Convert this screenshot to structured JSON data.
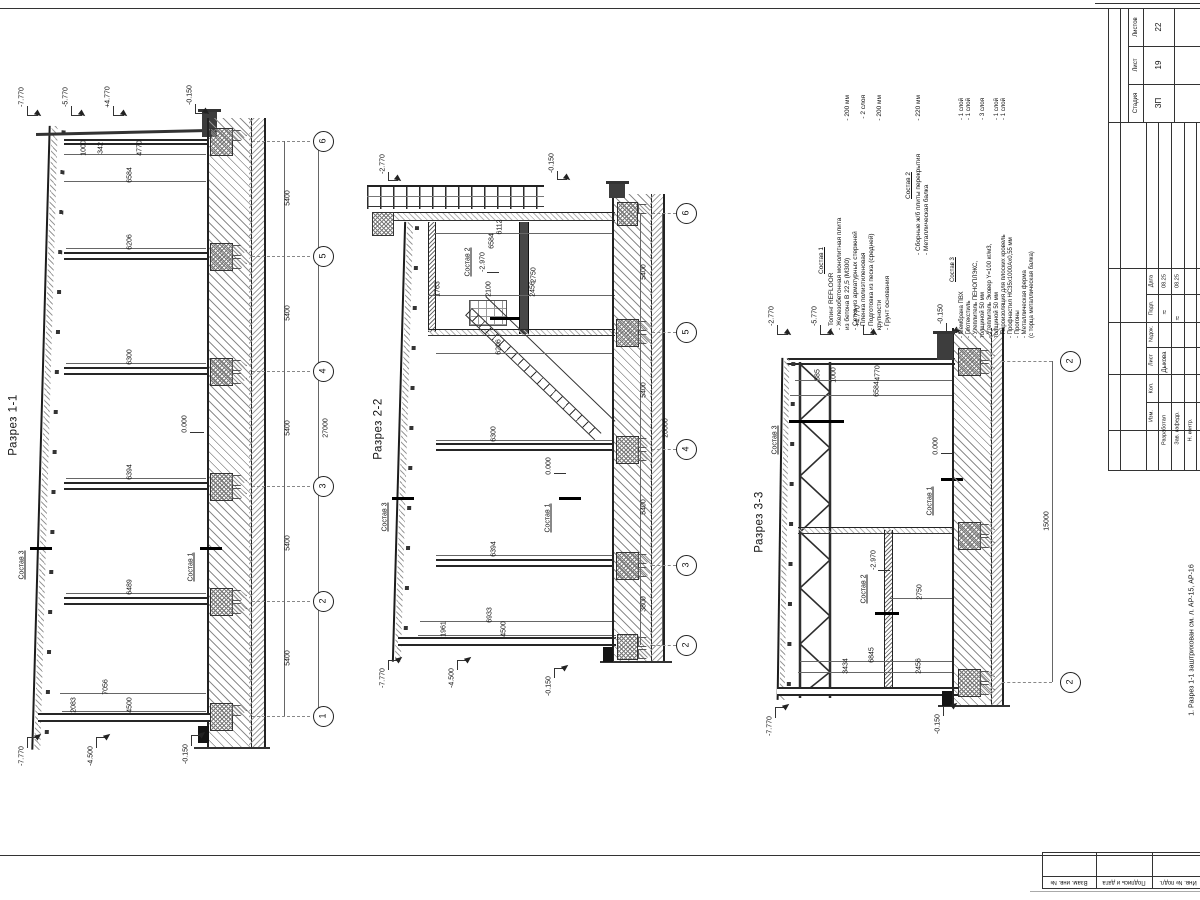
{
  "sheet": {
    "note_bottom": "1. Разрез 1-1 заштрихован см. л. АР-15, АР-16"
  },
  "sections": [
    {
      "title": "Разрез 1-1",
      "axes": [
        "6",
        "5",
        "4",
        "3",
        "2",
        "1"
      ],
      "bays": [
        "5400",
        "5400",
        "5400",
        "5400",
        "5400"
      ],
      "total": "27000",
      "dims": {
        "d1000": "1000",
        "d342": "342",
        "d4770": "4770",
        "d6584": "6584",
        "d6206": "6206",
        "d6300": "6300",
        "d6394": "6394",
        "d6489": "6489",
        "d7056": "7056",
        "d2083": "2083",
        "d4500": "4500"
      },
      "elev": {
        "t1": "-7.770",
        "t2": "-5.770",
        "t3": "+4.770",
        "t4": "-0.150",
        "m1": "0.000",
        "b1": "-7.770",
        "b2": "-4.500",
        "b3": "-0.150"
      },
      "marks": {
        "m1": "Состав 3",
        "m2": "Состав 1"
      }
    },
    {
      "title": "Разрез 2-2",
      "axes": [
        "6",
        "5",
        "4",
        "3",
        "2"
      ],
      "bays": [
        "5400",
        "5400",
        "5400",
        "3800"
      ],
      "total": "20000",
      "dims": {
        "d6112": "6112",
        "d6584": "6584",
        "d2750": "2750",
        "d2456": "2456",
        "d2100": "2100",
        "d1763": "1763",
        "d6206": "6206",
        "d6300": "6300",
        "d6394": "6394",
        "d6933": "6933",
        "d1961": "1961",
        "d4500": "4500"
      },
      "elev": {
        "t1": "-2.770",
        "t4": "-0.150",
        "m1": "0.000",
        "m2": "-2.970",
        "b1": "-7.770",
        "b2": "-4.500",
        "b3": "-0.150"
      },
      "marks": {
        "m1": "Состав 3",
        "m2": "Состав 1",
        "m3": "Состав 2"
      }
    },
    {
      "title": "Разрез 3-3",
      "axes": [
        "2",
        "2"
      ],
      "total": "15000",
      "dims": {
        "d385": "385",
        "d1000": "1000",
        "d4770": "4770",
        "d6584": "6584",
        "d2750": "2750",
        "d6845": "6845",
        "d3434": "3434",
        "d2456": "2456"
      },
      "elev": {
        "t1": "-2.770",
        "t2": "-5.770",
        "t3": "+4.770",
        "t4": "-0.150",
        "m1": "0.000",
        "m2": "-2.970",
        "b1": "-7.770",
        "b3": "-0.150"
      },
      "marks": {
        "m1": "Состав 3",
        "m2": "Состав 1",
        "m3": "Состав 2"
      }
    }
  ],
  "notes": {
    "s1": {
      "header": "Состав 1",
      "items": [
        {
          "t": "- Топинг REFLOOR",
          "v": ""
        },
        {
          "t": "- Железобетонная монолитная плита",
          "v": ""
        },
        {
          "t": "  из бетона В 22,5 (М300)",
          "v": "- 200 мм"
        },
        {
          "t": "- Сетка из арматурных стержней",
          "v": ""
        },
        {
          "t": "- Пленка полиэтиленовая",
          "v": "- 2 слоя"
        },
        {
          "t": "- Подготовка из песка (средней)",
          "v": ""
        },
        {
          "t": "  крупности",
          "v": "- 200 мм"
        },
        {
          "t": "- Грунт основания",
          "v": ""
        }
      ]
    },
    "s2": {
      "header": "Состав 2",
      "items": [
        {
          "t": "- Сборные ж/б плиты перекрытия",
          "v": "- 220 мм"
        },
        {
          "t": "- Металлическая балка",
          "v": ""
        }
      ]
    },
    "s3": {
      "header": "Состав 3",
      "items": [
        {
          "t": "- Мембрана ПВХ",
          "v": "- 1 слой"
        },
        {
          "t": "- Геотекстиль",
          "v": "- 1 слой"
        },
        {
          "t": "- Утеплитель ПЕНОПЛЭКС,",
          "v": ""
        },
        {
          "t": "  толщиной 50 мм",
          "v": "- 3 слоя"
        },
        {
          "t": "- Утеплитель Эковер Y=100 кг/м3,",
          "v": ""
        },
        {
          "t": "  толщиной 50 мм",
          "v": "- 1 слой"
        },
        {
          "t": "- Пароизоляция для плоских кровель",
          "v": "- 1 слой"
        },
        {
          "t": "- Профнастил НС35х1000Ах0,55 мм",
          "v": ""
        },
        {
          "t": "- Прогоны",
          "v": ""
        },
        {
          "t": "- Металлическая ферма",
          "v": ""
        },
        {
          "t": "  (с торца металлическая балка)",
          "v": ""
        }
      ]
    }
  },
  "titleblock": {
    "stage_label": "Стадия",
    "stage": "ЗП",
    "sheet_label": "Лист",
    "sheet": "19",
    "sheets_label": "Листов",
    "sheets": "22",
    "hdr": [
      "Изм.",
      "Кол.",
      "Лист",
      "№док.",
      "Подп.",
      "Дата"
    ],
    "rows": [
      {
        "role": "Разработал",
        "name": "Дыкова",
        "date": "08.25"
      },
      {
        "role": "Зав. кафедр.",
        "name": "",
        "date": "08.25"
      },
      {
        "role": "Н. контр.",
        "name": "",
        "date": ""
      }
    ],
    "sig_glyph": "≈",
    "stamps": [
      "Взам. инв. №",
      "Подпись и дата",
      "Инв. № подл."
    ]
  }
}
